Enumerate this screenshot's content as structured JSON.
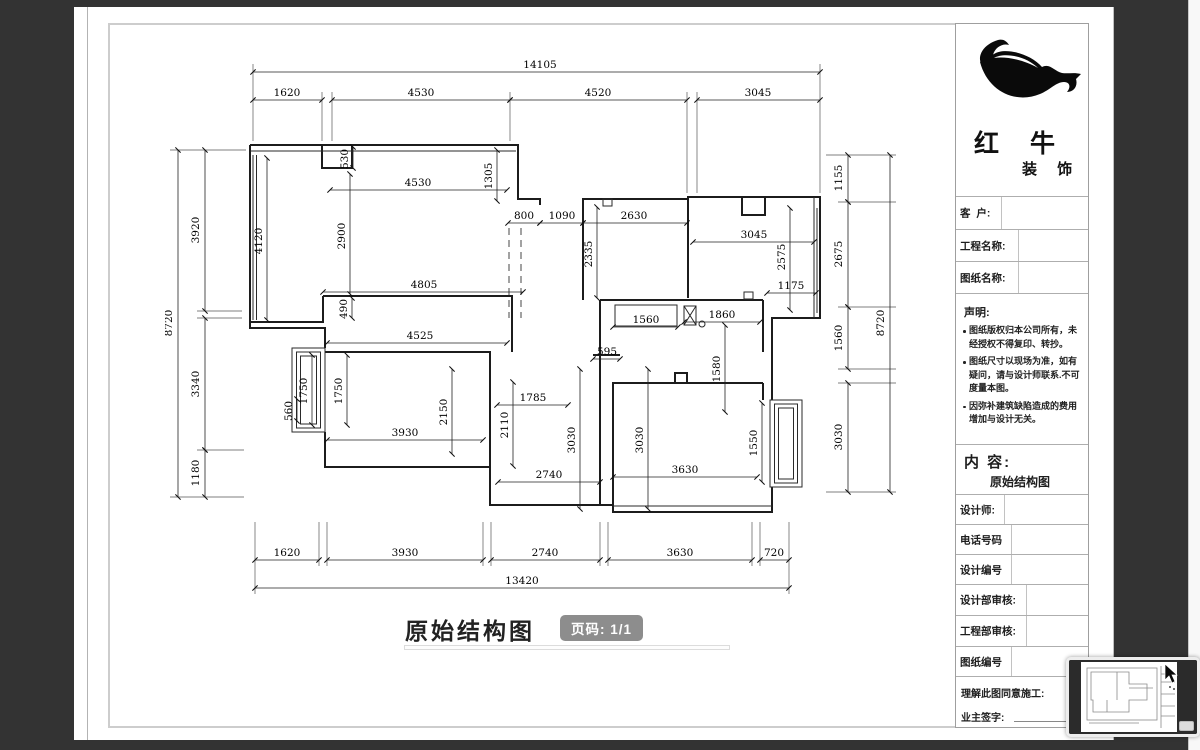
{
  "viewer": {
    "page_badge": "页码: 1/1"
  },
  "sheet": {
    "logo": {
      "line1": "红 牛",
      "line2": "装 饰"
    },
    "fields_top": [
      {
        "label": "客  户:"
      },
      {
        "label": "工程名称:"
      },
      {
        "label": "图纸名称:"
      }
    ],
    "statement": {
      "title": "声明:",
      "items": [
        "图纸版权归本公司所有，未经授权不得复印、转抄。",
        "图纸尺寸以现场为准，如有疑问，请与设计师联系.不可度量本图。",
        "因弥补建筑缺陷造成的费用增加与设计无关。"
      ]
    },
    "content": {
      "label": "内 容:",
      "value": "原始结构图"
    },
    "fields_bottom": [
      {
        "label": "设计师:"
      },
      {
        "label": "电话号码"
      },
      {
        "label": "设计编号"
      },
      {
        "label": "设计部审核:"
      },
      {
        "label": "工程部审核:"
      },
      {
        "label": "图纸编号"
      }
    ],
    "footer": {
      "line1": "理解此图同意施工:",
      "line2": "业主签字:"
    },
    "drawing_title": "原始结构图"
  },
  "plan": {
    "dims": [
      "14105",
      "1620",
      "4530",
      "4520",
      "3045",
      "8720",
      "3920",
      "3340",
      "1180",
      "1155",
      "2675",
      "1560",
      "3030",
      "8720",
      "1620",
      "3930",
      "2740",
      "3630",
      "720",
      "13420",
      "530",
      "4530",
      "1305",
      "2900",
      "4120",
      "800",
      "1090",
      "2630",
      "2335",
      "3045",
      "2575",
      "1175",
      "4805",
      "490",
      "4525",
      "1560",
      "1860",
      "1580",
      "595",
      "1750",
      "1750",
      "560",
      "2150",
      "1785",
      "2110",
      "3930",
      "3030",
      "3030",
      "2740",
      "3630",
      "1550"
    ]
  }
}
